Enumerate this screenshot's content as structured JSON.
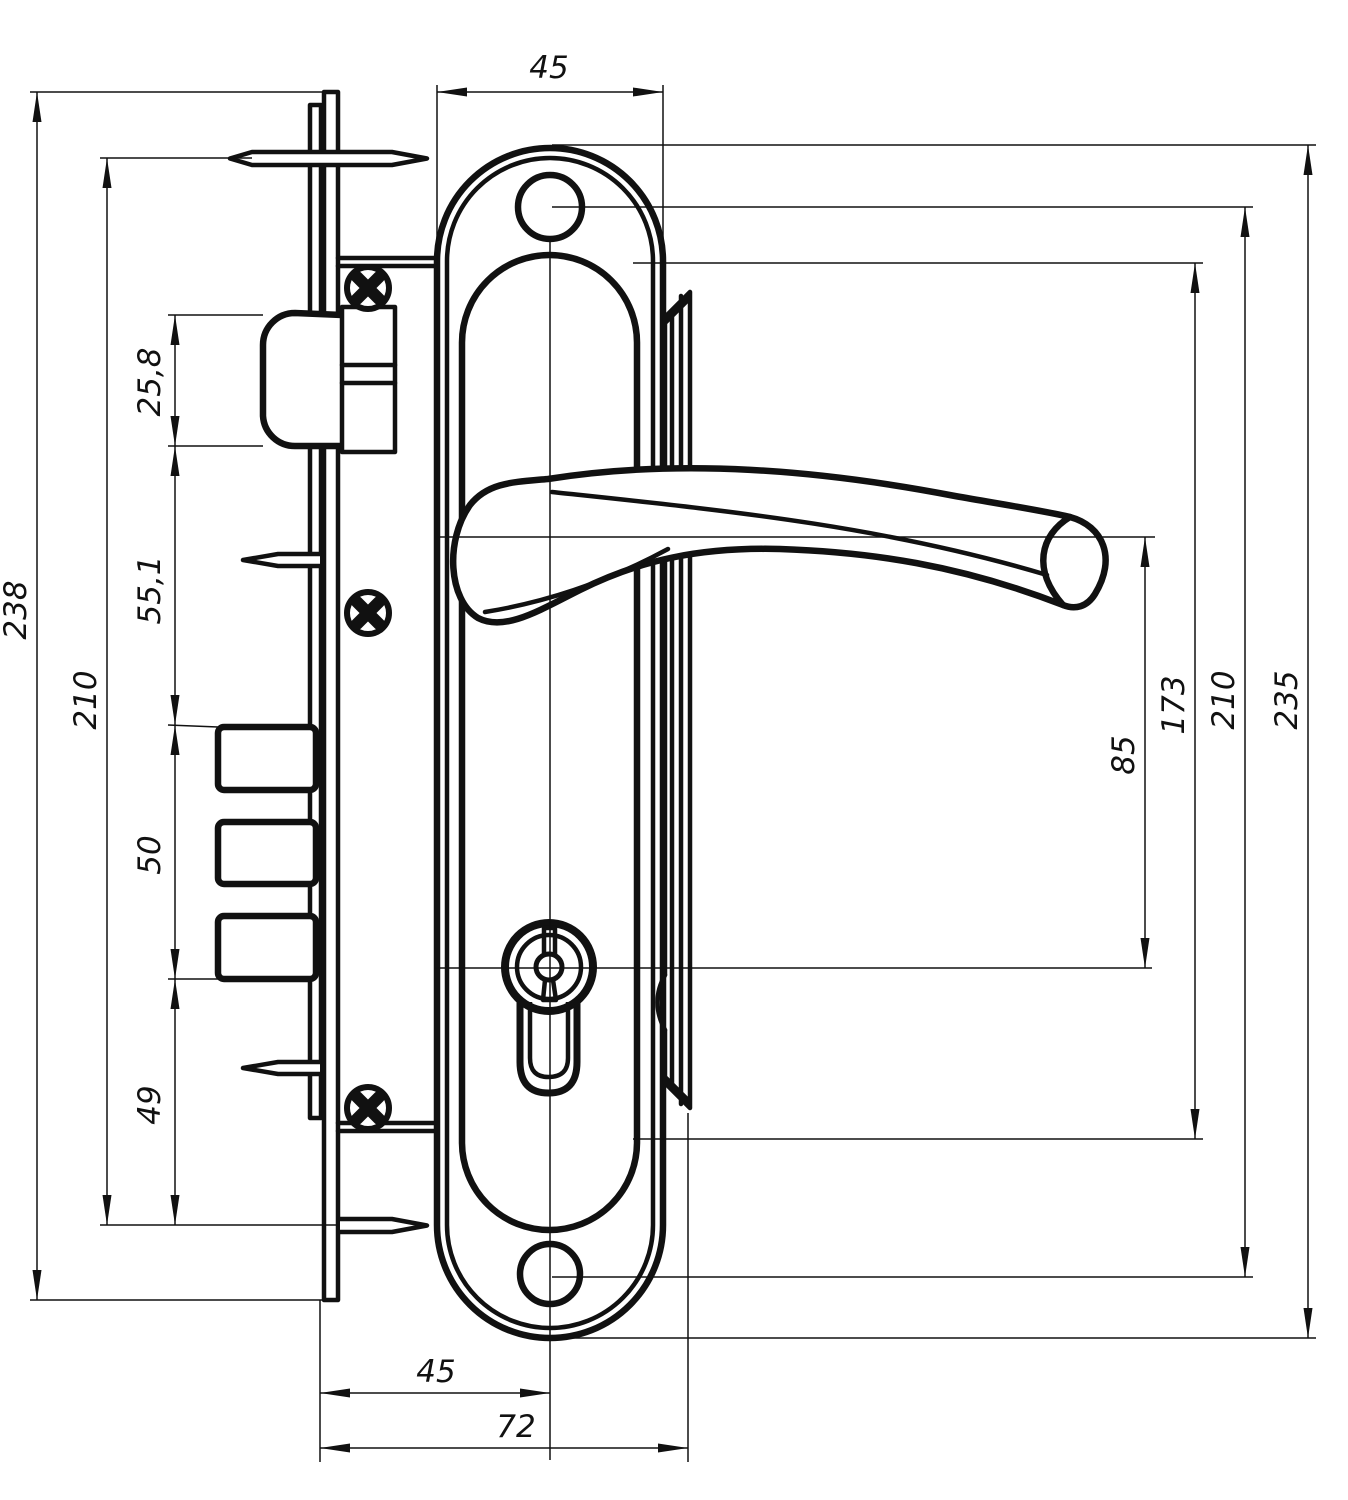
{
  "drawing": {
    "title": "door-lock-set-technical-drawing",
    "colors": {
      "ink": "#111111",
      "background": "#ffffff"
    },
    "dimensions": {
      "plate_width_top": "45",
      "total_height_left": "238",
      "pin_spacing_left": "210",
      "latch_height": "25,8",
      "latch_to_bolts": "55,1",
      "bolts_span": "50",
      "bolts_to_pin": "49",
      "handle_to_cylinder": "85",
      "inner_panel_height": "173",
      "screw_hole_spacing": "210",
      "plate_height": "235",
      "backset_bottom": "45",
      "total_depth_bottom": "72"
    }
  }
}
